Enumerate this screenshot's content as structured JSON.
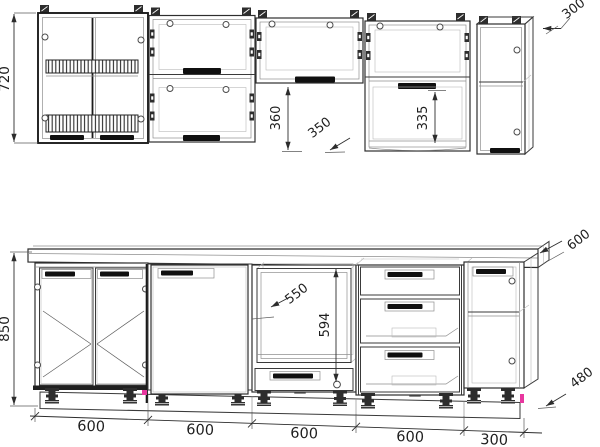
{
  "colors": {
    "line": "#3a3a3a",
    "accent": "#e8379f",
    "background": "#ffffff"
  },
  "upper_row": {
    "height": "720",
    "depth": "300",
    "below_gap_height": "360",
    "gap_width": "350",
    "open_niche_height": "335"
  },
  "base_row": {
    "height": "850",
    "worktop_depth": "600",
    "right_height": "480",
    "oven_niche_width": "550",
    "oven_niche_height": "594",
    "width_chain": [
      "600",
      "600",
      "600",
      "600",
      "300"
    ]
  }
}
